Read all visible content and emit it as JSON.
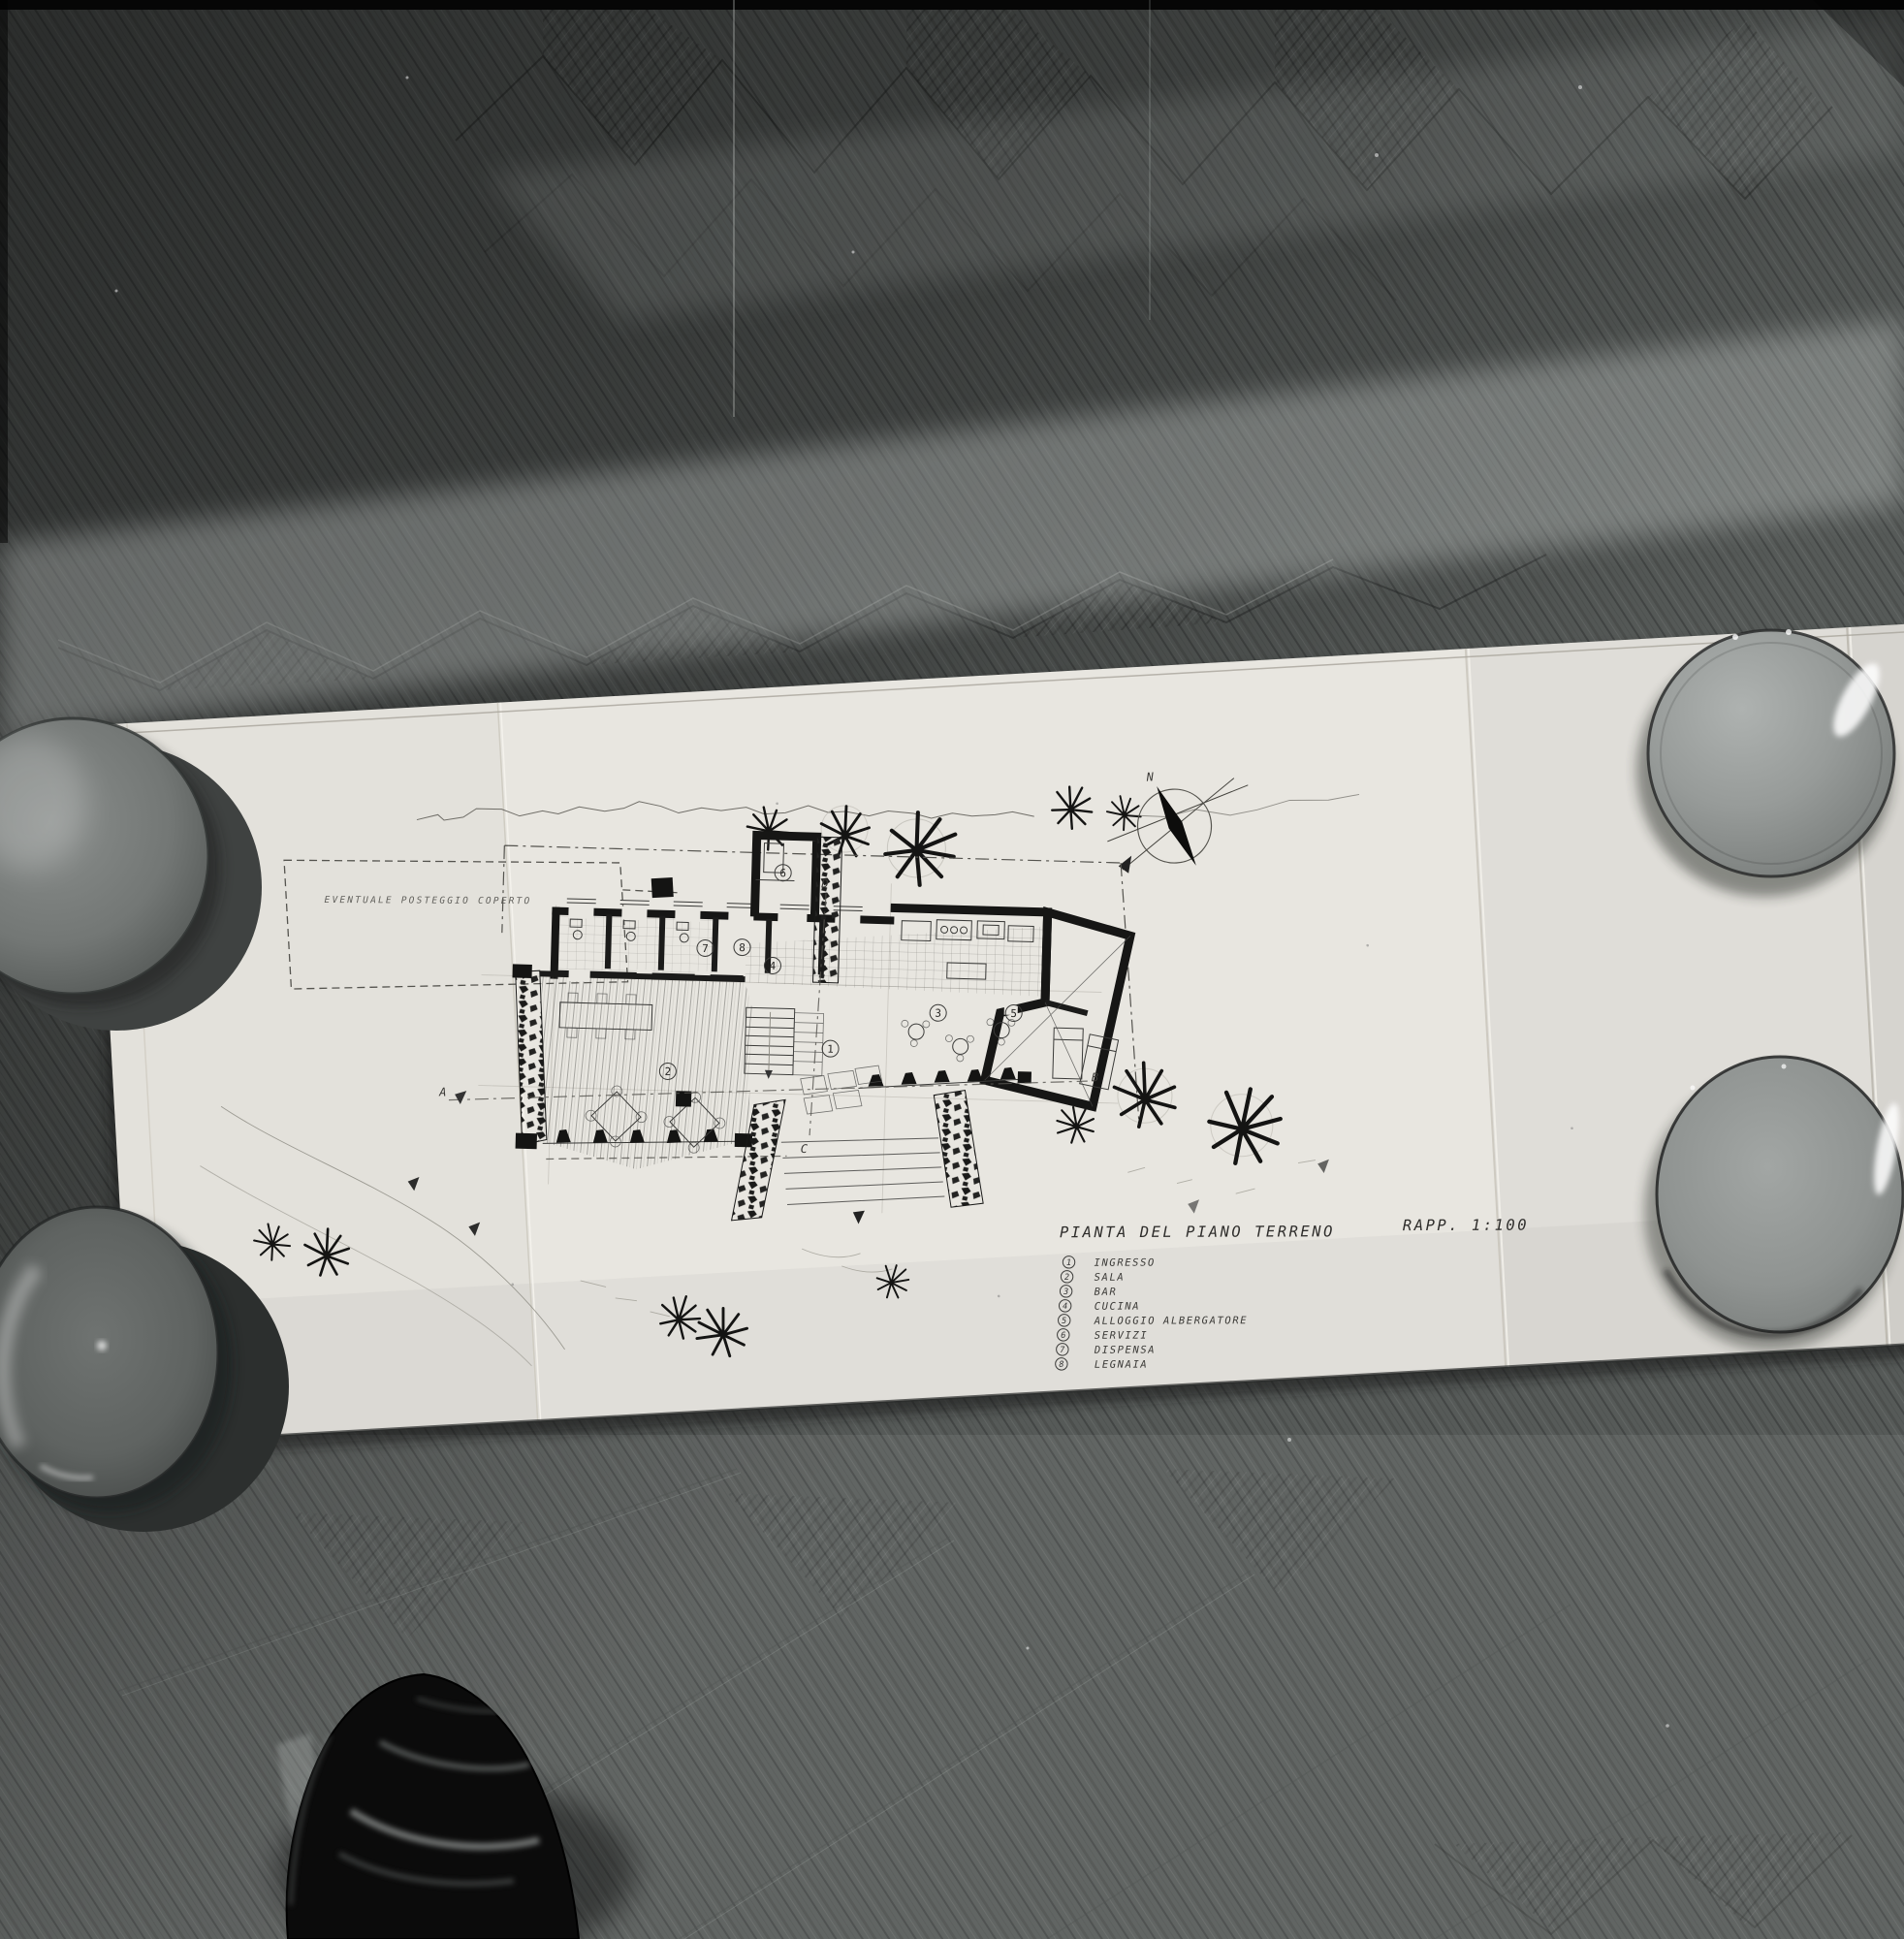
{
  "scene": {
    "medium": "black-and-white photograph",
    "subject": "architectural plan sheet on herringbone parquet floor weighted by four bowls, photographer's shoe at bottom"
  },
  "drawing": {
    "title": "PIANTA DEL PIANO TERRENO",
    "scale_label": "RAPP. 1:100",
    "annotations": {
      "parking": "EVENTUALE POSTEGGIO COPERTO",
      "compass_north": "N"
    },
    "sections": {
      "a": "A",
      "b": "B",
      "c": "C",
      "d": "D"
    },
    "rooms": {
      "r1": "1",
      "r2": "2",
      "r3": "3",
      "r4": "4",
      "r5": "5",
      "r6": "6",
      "r7": "7",
      "r8": "8"
    },
    "legend": {
      "items": [
        {
          "num": "1",
          "label": "INGRESSO"
        },
        {
          "num": "2",
          "label": "SALA"
        },
        {
          "num": "3",
          "label": "BAR"
        },
        {
          "num": "4",
          "label": "CUCINA"
        },
        {
          "num": "5",
          "label": "ALLOGGIO ALBERGATORE"
        },
        {
          "num": "6",
          "label": "SERVIZI"
        },
        {
          "num": "7",
          "label": "DISPENSA"
        },
        {
          "num": "8",
          "label": "LEGNAIA"
        }
      ]
    }
  },
  "colors": {
    "floor_dark": "#2e302f",
    "floor_mid": "#565a58",
    "floor_light": "#8b908e",
    "paper": "#e8e6e0",
    "ink": "#1c1c1b",
    "bowl_gray": "#8f9391",
    "shoe_black": "#0b0b0b"
  }
}
